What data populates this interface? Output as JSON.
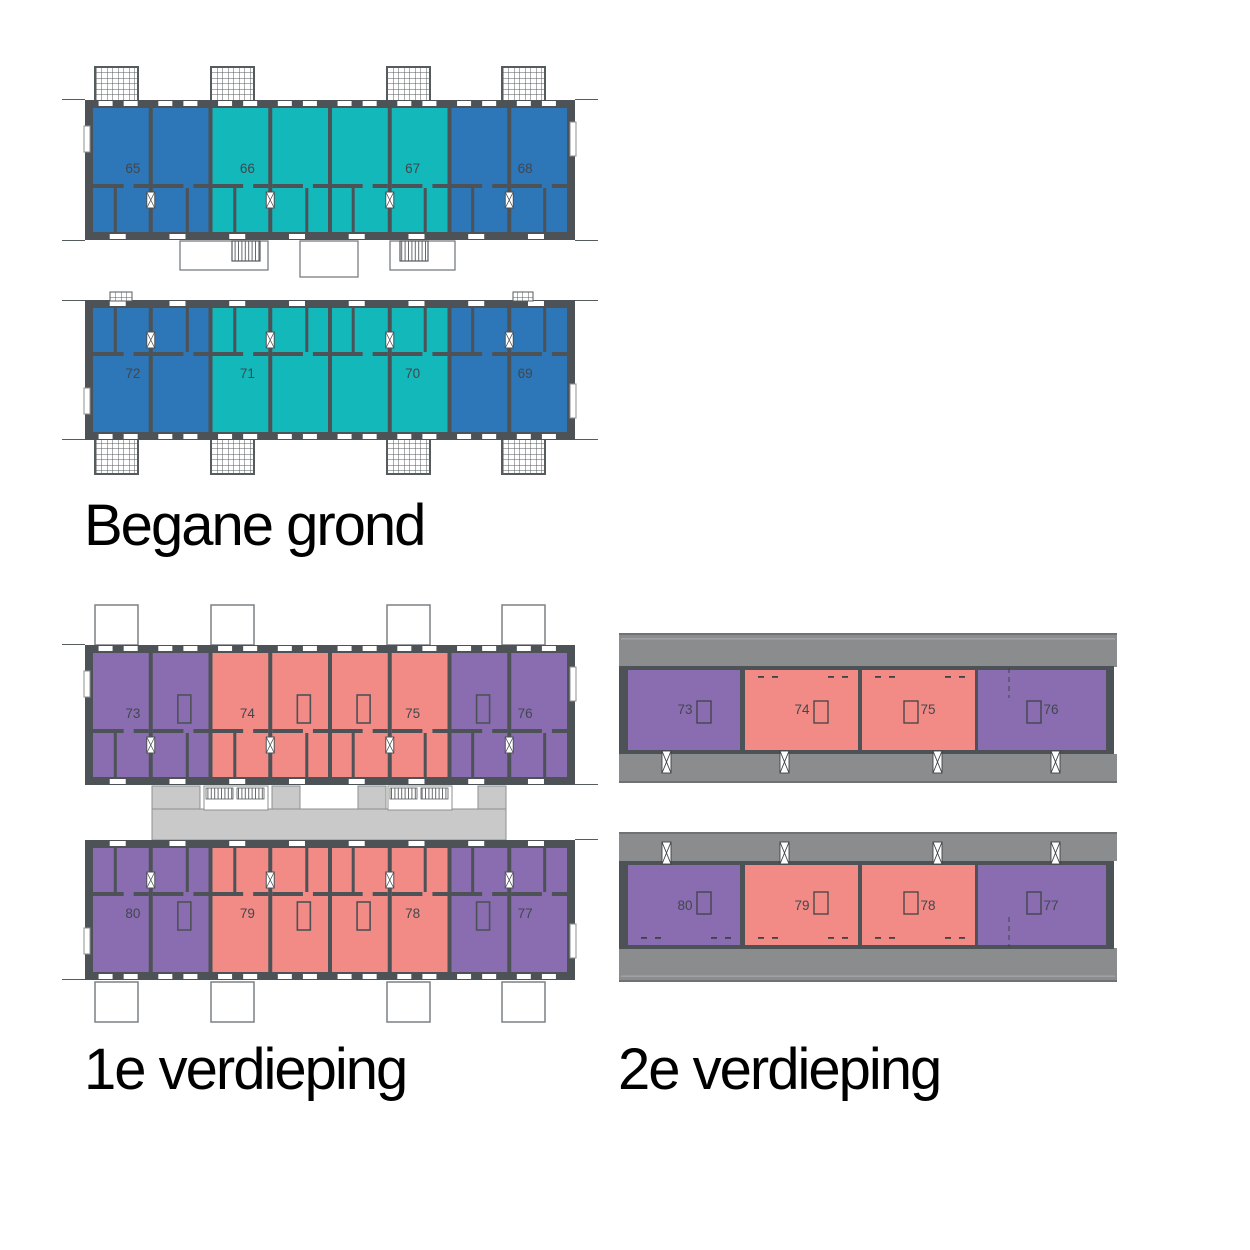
{
  "page": {
    "background": "#ffffff"
  },
  "colors": {
    "blue": "#2d76b8",
    "teal": "#12b8ba",
    "purple": "#8a6cb1",
    "salmon": "#f28b86",
    "wall_dark": "#4d5256",
    "roof_gray": "#8a8c8e",
    "walkway_gray": "#c9c9ca",
    "outline_gray": "#6f7173",
    "hatch_line": "#565b5e",
    "unit_number_text": "#41474d",
    "label_text": "#000000"
  },
  "sections": [
    {
      "id": "begane-grond",
      "label": "Begane grond",
      "buildings": [
        {
          "name": "north-block",
          "units": [
            {
              "number": "65",
              "color": "blue"
            },
            {
              "number": "66",
              "color": "teal"
            },
            {
              "number": "67",
              "color": "teal"
            },
            {
              "number": "68",
              "color": "blue"
            }
          ]
        },
        {
          "name": "south-block",
          "units": [
            {
              "number": "72",
              "color": "blue"
            },
            {
              "number": "71",
              "color": "teal"
            },
            {
              "number": "70",
              "color": "teal"
            },
            {
              "number": "69",
              "color": "blue"
            }
          ]
        }
      ]
    },
    {
      "id": "eerste-verdieping",
      "label": "1e verdieping",
      "buildings": [
        {
          "name": "north-block",
          "units": [
            {
              "number": "73",
              "color": "purple"
            },
            {
              "number": "74",
              "color": "salmon"
            },
            {
              "number": "75",
              "color": "salmon"
            },
            {
              "number": "76",
              "color": "purple"
            }
          ]
        },
        {
          "name": "south-block",
          "units": [
            {
              "number": "80",
              "color": "purple"
            },
            {
              "number": "79",
              "color": "salmon"
            },
            {
              "number": "78",
              "color": "salmon"
            },
            {
              "number": "77",
              "color": "purple"
            }
          ]
        }
      ]
    },
    {
      "id": "tweede-verdieping",
      "label": "2e verdieping",
      "buildings": [
        {
          "name": "north-block",
          "units": [
            {
              "number": "73",
              "color": "purple"
            },
            {
              "number": "74",
              "color": "salmon"
            },
            {
              "number": "75",
              "color": "salmon"
            },
            {
              "number": "76",
              "color": "purple"
            }
          ]
        },
        {
          "name": "south-block",
          "units": [
            {
              "number": "80",
              "color": "purple"
            },
            {
              "number": "79",
              "color": "salmon"
            },
            {
              "number": "78",
              "color": "salmon"
            },
            {
              "number": "77",
              "color": "purple"
            }
          ]
        }
      ]
    }
  ]
}
